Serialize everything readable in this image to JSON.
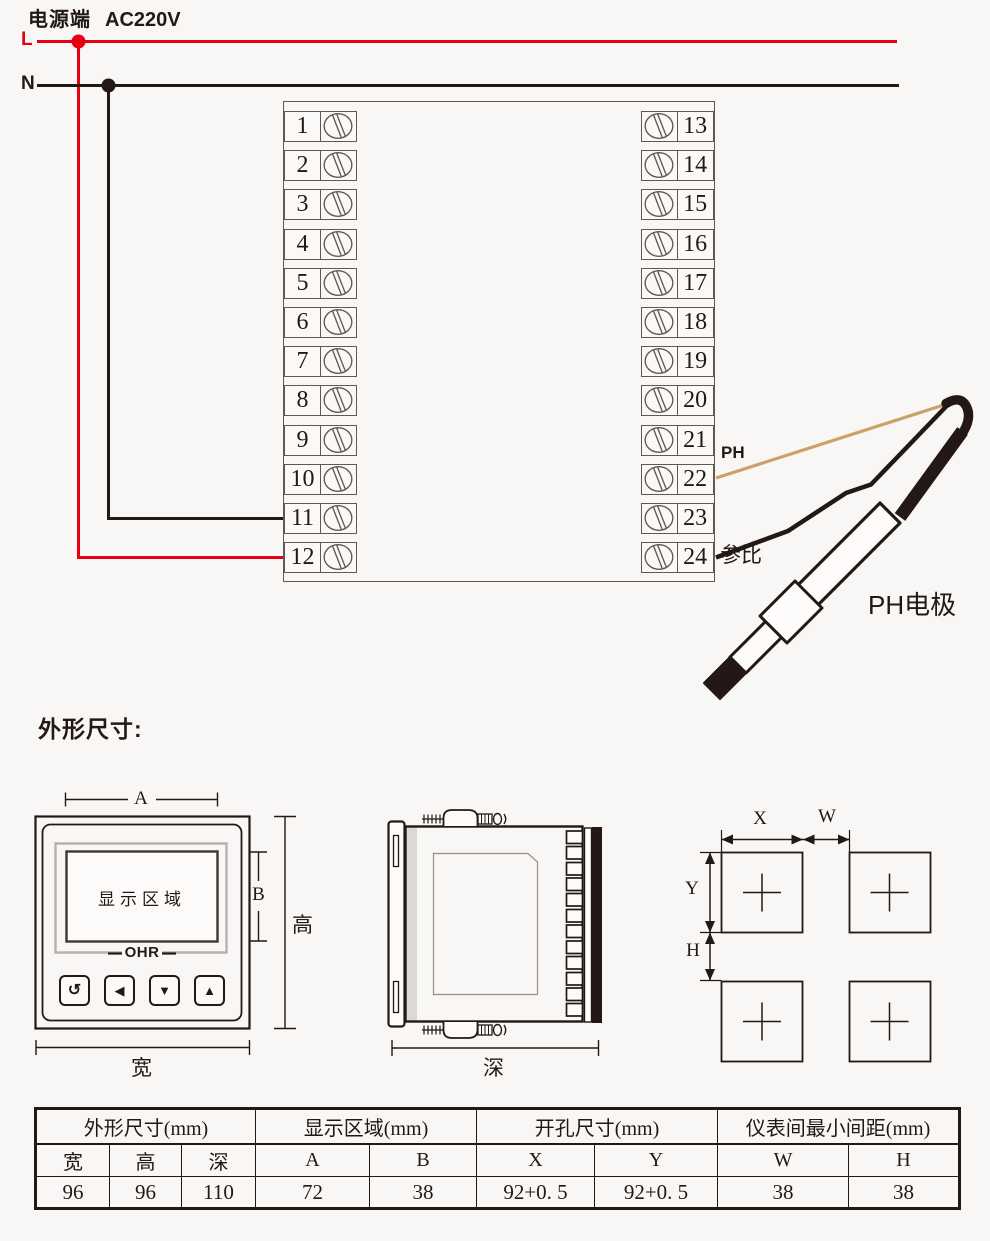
{
  "power": {
    "label": "电源端",
    "voltage": "AC220V",
    "line_l": "L",
    "line_n": "N"
  },
  "terminals": {
    "left": [
      "1",
      "2",
      "3",
      "4",
      "5",
      "6",
      "7",
      "8",
      "9",
      "10",
      "11",
      "12"
    ],
    "right": [
      "13",
      "14",
      "15",
      "16",
      "17",
      "18",
      "19",
      "20",
      "21",
      "22",
      "23",
      "24"
    ]
  },
  "electrode": {
    "ph_wire_label": "PH",
    "ref_wire_label": "参比",
    "name": "PH电极"
  },
  "outline_heading": "外形尺寸:",
  "front_view": {
    "dim_a": "A",
    "dim_b": "B",
    "height_label": "高",
    "width_label": "宽",
    "display_area": "显示区域",
    "brand": "OHR",
    "buttons": [
      "↺",
      "◀",
      "▼",
      "▲"
    ]
  },
  "side_view": {
    "depth_label": "深"
  },
  "cutout_view": {
    "dim_x": "X",
    "dim_w": "W",
    "dim_y": "Y",
    "dim_h": "H"
  },
  "spec_table": {
    "groups": [
      {
        "label": "外形尺寸(mm)"
      },
      {
        "label": "显示区域(mm)"
      },
      {
        "label": "开孔尺寸(mm)"
      },
      {
        "label": "仪表间最小间距(mm)"
      }
    ],
    "columns": [
      "宽",
      "高",
      "深",
      "A",
      "B",
      "X",
      "Y",
      "W",
      "H"
    ],
    "values": [
      "96",
      "96",
      "110",
      "72",
      "38",
      "92+0. 5",
      "92+0. 5",
      "38",
      "38"
    ]
  },
  "colors": {
    "live": "#e60012",
    "neutral": "#231815",
    "ph_wire": "#c9a266",
    "ink": "#231815"
  }
}
